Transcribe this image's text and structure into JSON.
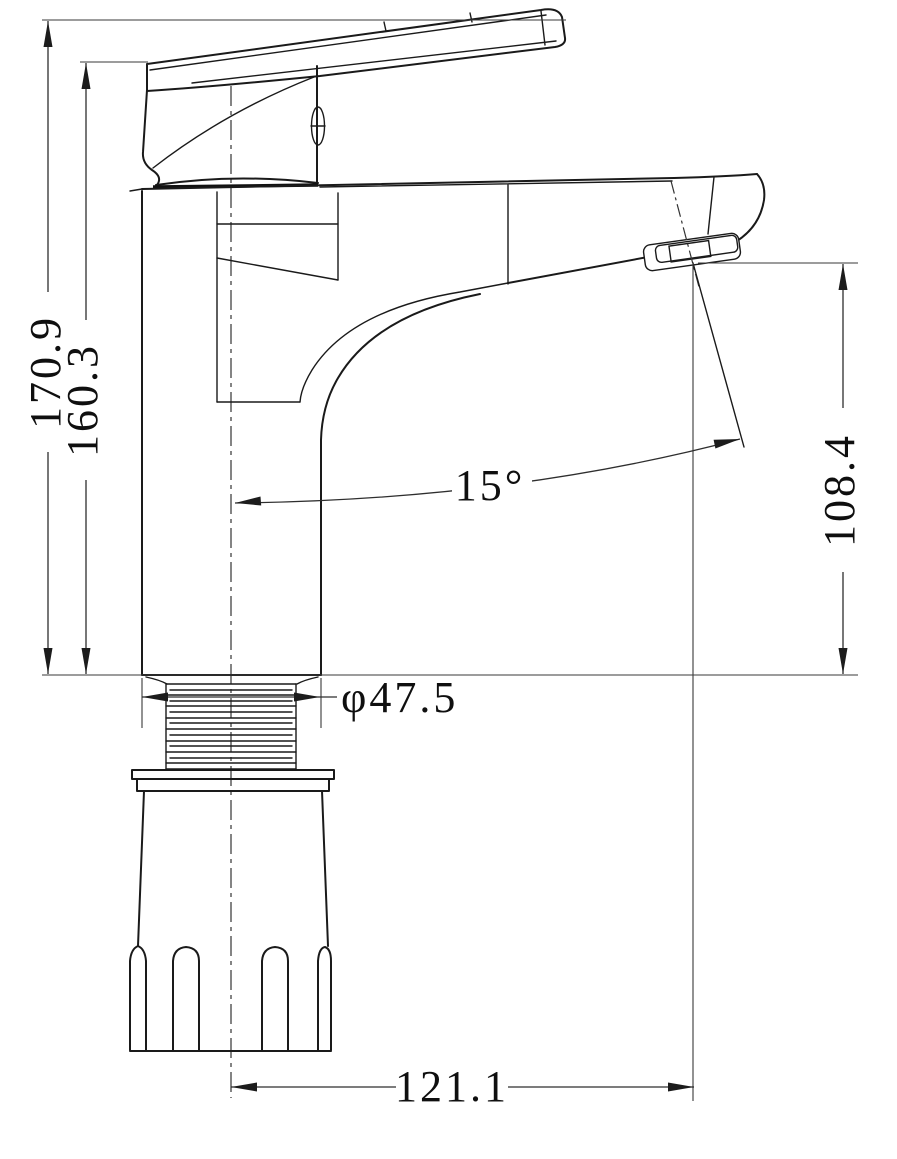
{
  "colors": {
    "background": "#ffffff",
    "part_line": "#1a1a1a",
    "dimension_line": "#2e2e2e",
    "text": "#0f0f0f"
  },
  "dims": {
    "overall_height": "170.9",
    "body_height": "160.3",
    "spout_outlet_height": "108.4",
    "spout_angle": "15°",
    "thread_diameter": "φ47.5",
    "spout_reach": "121.1"
  }
}
